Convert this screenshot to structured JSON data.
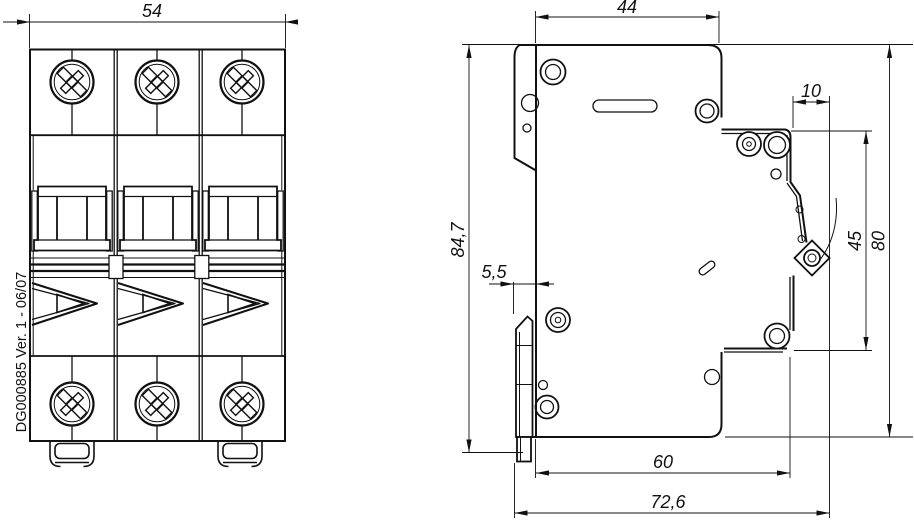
{
  "part_label": "DG000885 Ver. 1 - 06/07",
  "dimensions": {
    "front_width": "54",
    "side_top_width": "44",
    "overall_height": "84,7",
    "din_offset": "5,5",
    "terminal_pitch": "10",
    "terminal_span": "45",
    "body_height": "80",
    "base_depth": "60",
    "overall_depth": "72,6"
  },
  "colors": {
    "line": "#111111",
    "background": "#ffffff"
  }
}
